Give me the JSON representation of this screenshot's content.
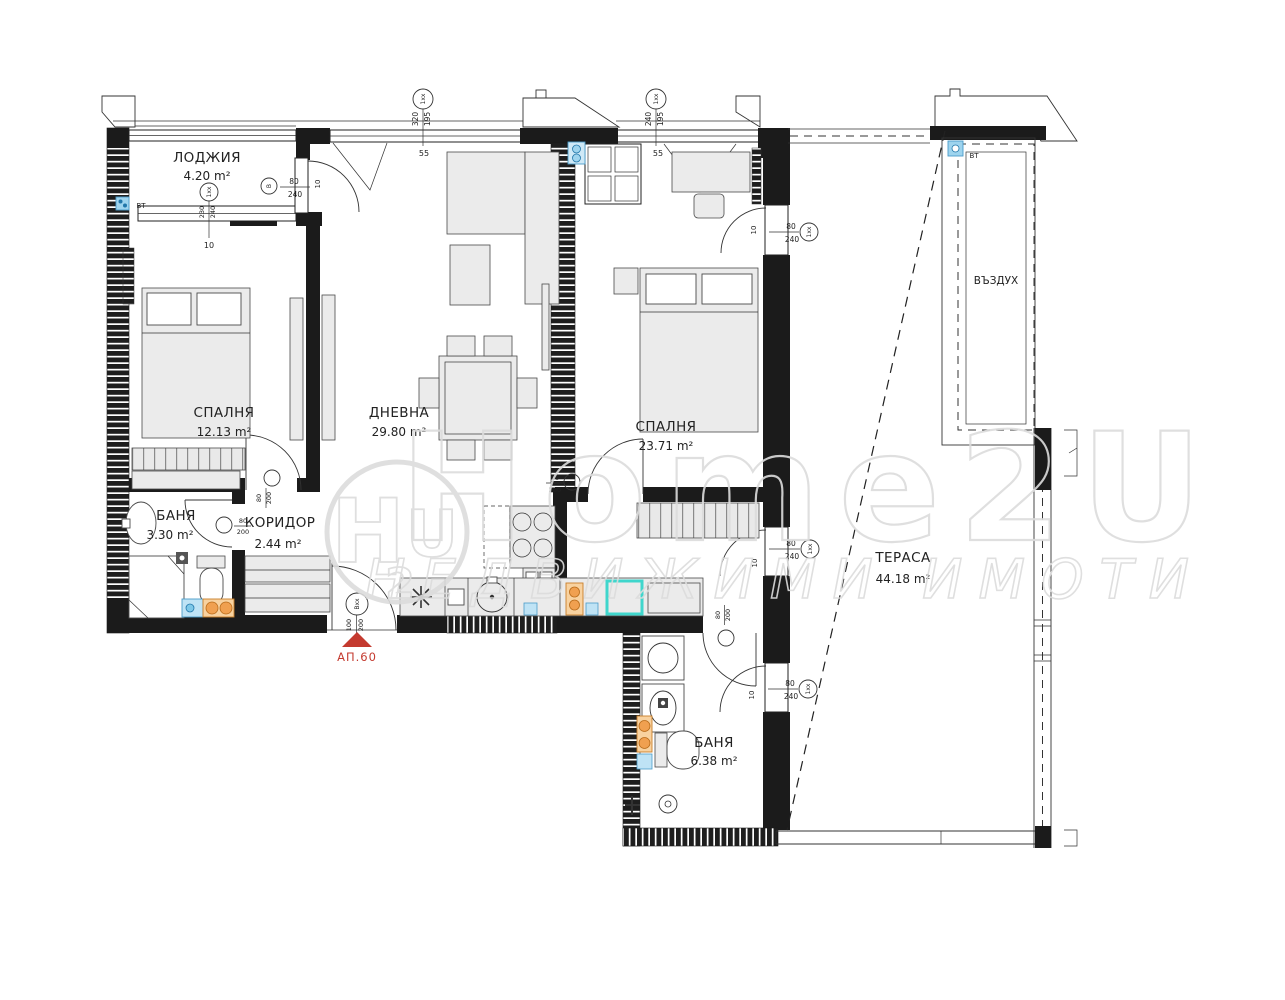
{
  "rooms": {
    "loggia": {
      "name": "ЛОДЖИЯ",
      "area": "4.20 m²"
    },
    "bedroom1": {
      "name": "СПАЛНЯ",
      "area": "12.13 m²"
    },
    "living": {
      "name": "ДНЕВНА",
      "area": "29.80 m²"
    },
    "bedroom2": {
      "name": "СПАЛНЯ",
      "area": "23.71 m²"
    },
    "bath1": {
      "name": "БАНЯ",
      "area": "3.30 m²"
    },
    "corridor": {
      "name": "КОРИДОР",
      "area": "2.44 m²"
    },
    "bath2": {
      "name": "БАНЯ",
      "area": "6.38 m²"
    },
    "terrace": {
      "name": "ТЕРАСА",
      "area": "44.18 m²"
    },
    "air_shaft": {
      "name": "ВЪЗДУХ"
    }
  },
  "entrance": {
    "label": "АП.60",
    "door_tag": "Bxx",
    "w": "100",
    "h": "200"
  },
  "bt": {
    "left": "BT",
    "right": "BT"
  },
  "windows": {
    "top_left": {
      "tag": "1xx",
      "w": "320",
      "h": "195",
      "sill": "55"
    },
    "top_right": {
      "tag": "1xx",
      "w": "240",
      "h": "195",
      "sill": "55"
    },
    "loggia": {
      "tag": "1xx",
      "w": "230",
      "h": "240",
      "off": "10"
    }
  },
  "doors": {
    "loggia": {
      "tag": "B",
      "w": "80",
      "h": "240",
      "off": "10"
    },
    "bedroom1": {
      "w": "80",
      "h": "200"
    },
    "bath1": {
      "w": "80",
      "h": "200"
    },
    "bedroom2": {
      "w": "80",
      "h": "200"
    },
    "bath2": {
      "w": "80",
      "h": "200"
    },
    "terrace_top": {
      "tag": "1xx",
      "w": "80",
      "h": "240",
      "off": "10"
    },
    "terrace_mid": {
      "tag": "1xx",
      "w": "80",
      "h": "240",
      "off": "10"
    },
    "terrace_bath": {
      "tag": "1xx",
      "w": "80",
      "h": "240",
      "off": "10"
    }
  },
  "watermark": {
    "logo_h": "H",
    "logo_2": "2",
    "logo_u": "U",
    "title": "Home2U",
    "subtitle": "НЕДВИЖИМИ ИМОТИ"
  },
  "colors": {
    "wall": "#1b1b1b",
    "entrance_red": "#c43a2f",
    "fixture_blue": "#9ed4ee",
    "fixture_orange": "#f0a050",
    "shower_cyan": "#3fd6cc",
    "watermark_gray": "#dcdcdc"
  }
}
